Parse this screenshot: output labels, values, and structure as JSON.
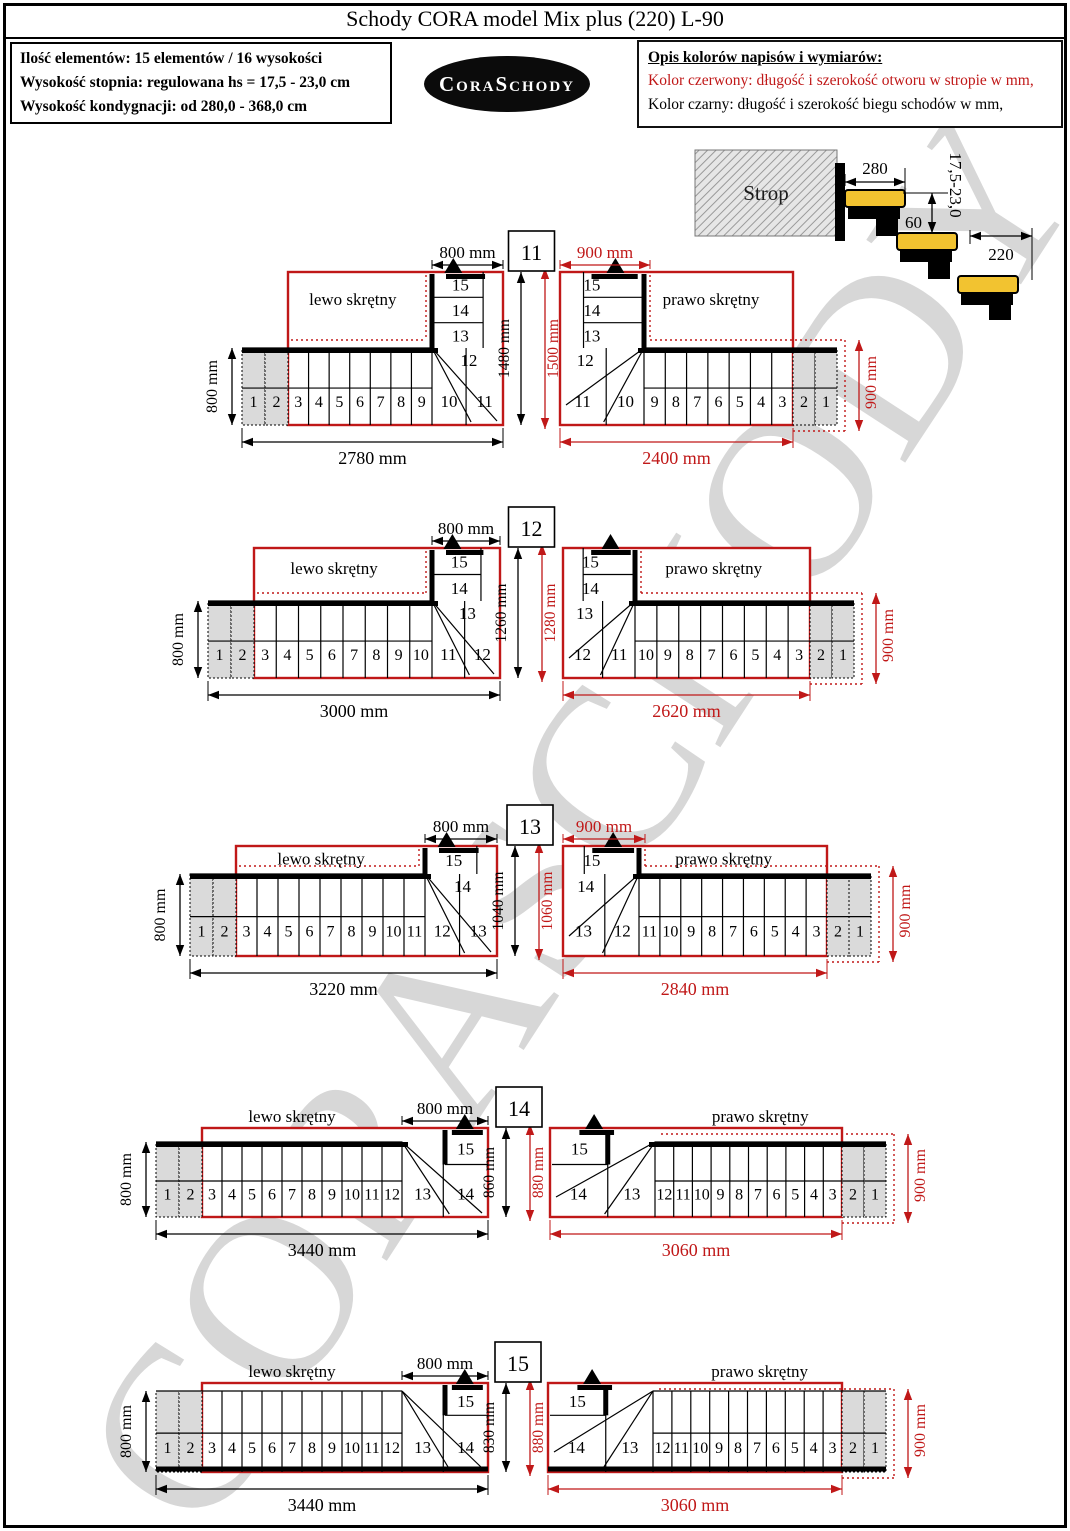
{
  "title": "Schody CORA model Mix plus (220) L-90",
  "info_box": {
    "lines": [
      "Ilość elementów: 15 elementów / 16 wysokości",
      "Wysokość stopnia: regulowana  hs = 17,5 - 23,0 cm",
      "Wysokość kondygnacji: od 280,0 - 368,0 cm"
    ]
  },
  "logo_text": "CoraSchody",
  "legend": {
    "heading": "Opis kolorów napisów i wymiarów:",
    "red_line": "Kolor czerwony:  długość i szerokość otworu w stropie w mm,",
    "black_line": "Kolor czarny:  długość i szerokość biegu schodów w mm,"
  },
  "watermark_text": "CORASCHODY",
  "colors": {
    "red": "#c01818",
    "black": "#000000",
    "tread_yellow": "#f2c330",
    "gray_fill": "#dadada",
    "watermark_gray": "#d7d7d7"
  },
  "strop_detail": {
    "label": "Strop",
    "tread_depth_top": "280",
    "riser_range": "17,5-23,0",
    "overlap": "60",
    "tread_depth": "220"
  },
  "groups": [
    {
      "id": "11",
      "left": {
        "label": "lewo skrętny",
        "top_dim": "800 mm",
        "side_dim": "800 mm",
        "bottom_dim": "2780 mm",
        "gray_steps": [
          "1",
          "2"
        ],
        "run_steps": [
          "3",
          "4",
          "5",
          "6",
          "7",
          "8",
          "9",
          "10",
          "11"
        ],
        "col_steps": [
          "15",
          "14",
          "13"
        ],
        "corner_step": "12"
      },
      "mid": {
        "stair_length": "1480 mm",
        "opening_length": "1500 mm"
      },
      "right": {
        "label": "prawo skrętny",
        "top_dim": "900 mm",
        "side_dim": "900 mm",
        "bottom_dim": "2400 mm",
        "gray_steps": [
          "2",
          "1"
        ],
        "run_steps": [
          "11",
          "10",
          "9",
          "8",
          "7",
          "6",
          "5",
          "4",
          "3"
        ],
        "col_steps": [
          "15",
          "14",
          "13"
        ],
        "corner_step": "12"
      }
    },
    {
      "id": "12",
      "left": {
        "label": "lewo skrętny",
        "top_dim": "800 mm",
        "side_dim": "800 mm",
        "bottom_dim": "3000 mm",
        "gray_steps": [
          "1",
          "2"
        ],
        "run_steps": [
          "3",
          "4",
          "5",
          "6",
          "7",
          "8",
          "9",
          "10",
          "11",
          "12"
        ],
        "col_steps": [
          "15",
          "14"
        ],
        "corner_step": "13"
      },
      "mid": {
        "stair_length": "1260 mm",
        "opening_length": "1280 mm"
      },
      "right": {
        "label": "prawo skrętny",
        "top_dim": null,
        "side_dim": "900 mm",
        "bottom_dim": "2620 mm",
        "gray_steps": [
          "2",
          "1"
        ],
        "run_steps": [
          "12",
          "11",
          "10",
          "9",
          "8",
          "7",
          "6",
          "5",
          "4",
          "3"
        ],
        "col_steps": [
          "15",
          "14"
        ],
        "corner_step": "13"
      }
    },
    {
      "id": "13",
      "left": {
        "label": "lewo skrętny",
        "top_dim": "800 mm",
        "side_dim": "800 mm",
        "bottom_dim": "3220 mm",
        "gray_steps": [
          "1",
          "2"
        ],
        "run_steps": [
          "3",
          "4",
          "5",
          "6",
          "7",
          "8",
          "9",
          "10",
          "11",
          "12",
          "13"
        ],
        "col_steps": [
          "15"
        ],
        "corner_step": "14"
      },
      "mid": {
        "stair_length": "1040 mm",
        "opening_length": "1060 mm"
      },
      "right": {
        "label": "prawo skrętny",
        "top_dim": "900 mm",
        "side_dim": "900 mm",
        "bottom_dim": "2840 mm",
        "gray_steps": [
          "2",
          "1"
        ],
        "run_steps": [
          "13",
          "12",
          "11",
          "10",
          "9",
          "8",
          "7",
          "6",
          "5",
          "4",
          "3"
        ],
        "col_steps": [
          "15"
        ],
        "corner_step": "14"
      }
    },
    {
      "id": "14",
      "left": {
        "label": "lewo skrętny",
        "top_dim": "800 mm",
        "side_dim": "800 mm",
        "bottom_dim": "3440 mm",
        "gray_steps": [
          "1",
          "2"
        ],
        "run_steps": [
          "3",
          "4",
          "5",
          "6",
          "7",
          "8",
          "9",
          "10",
          "11",
          "12",
          "13",
          "14"
        ],
        "col_steps": [],
        "corner_step": "15"
      },
      "mid": {
        "stair_length": "860 mm",
        "opening_length": "880 mm"
      },
      "right": {
        "label": "prawo skrętny",
        "top_dim": null,
        "side_dim": "900 mm",
        "bottom_dim": "3060 mm",
        "gray_steps": [
          "2",
          "1"
        ],
        "run_steps": [
          "14",
          "13",
          "12",
          "11",
          "10",
          "9",
          "8",
          "7",
          "6",
          "5",
          "4",
          "3"
        ],
        "col_steps": [],
        "corner_step": "15"
      }
    },
    {
      "id": "15",
      "left": {
        "label": "lewo skrętny",
        "top_dim": "800 mm",
        "side_dim": "800 mm",
        "bottom_dim": "3440 mm",
        "gray_steps": [
          "1",
          "2"
        ],
        "run_steps": [
          "3",
          "4",
          "5",
          "6",
          "7",
          "8",
          "9",
          "10",
          "11",
          "12",
          "13",
          "14"
        ],
        "col_steps": [],
        "corner_step": "15"
      },
      "mid": {
        "stair_length": "830 mm",
        "opening_length": "880 mm"
      },
      "right": {
        "label": "prawo skrętny",
        "top_dim": null,
        "side_dim": "900 mm",
        "bottom_dim": "3060 mm",
        "gray_steps": [
          "2",
          "1"
        ],
        "run_steps": [
          "14",
          "13",
          "12",
          "11",
          "10",
          "9",
          "8",
          "7",
          "6",
          "5",
          "4",
          "3"
        ],
        "col_steps": [],
        "corner_step": "15"
      }
    }
  ]
}
